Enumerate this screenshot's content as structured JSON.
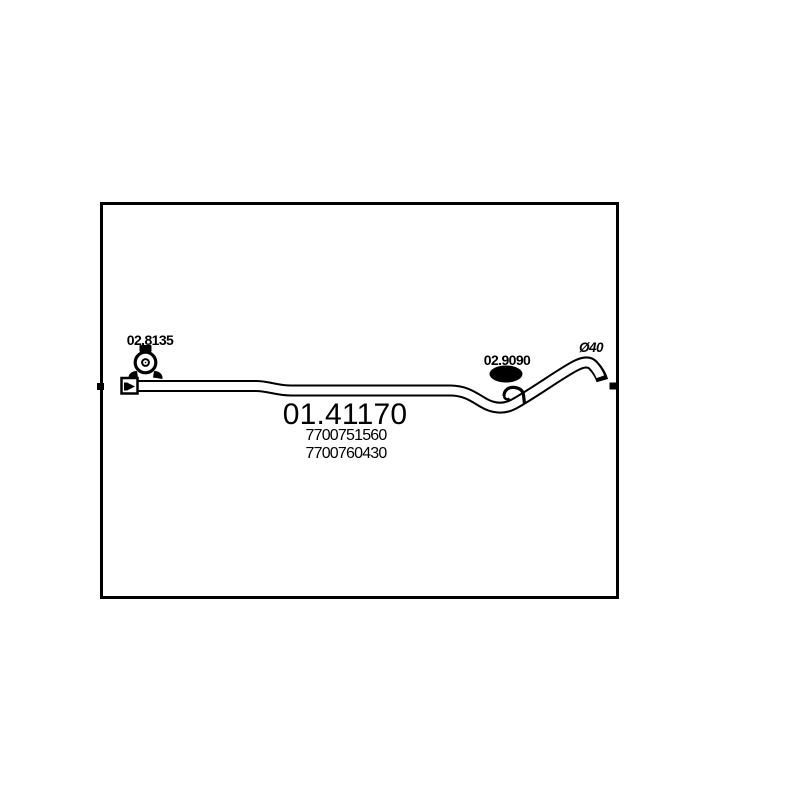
{
  "diagram": {
    "main_part_number": "01.41170",
    "oem_numbers": [
      "7700751560",
      "7700760430"
    ],
    "labels": {
      "left_clamp": "02.8135",
      "right_mount": "02.9090",
      "diameter": "Ø40"
    },
    "icons": {
      "left_clamp": "pipe-clamp-icon",
      "right_mount": "rubber-mount-icon",
      "inlet": "flow-direction-arrow-icon"
    },
    "colors": {
      "line": "#000000",
      "background": "#ffffff"
    }
  }
}
